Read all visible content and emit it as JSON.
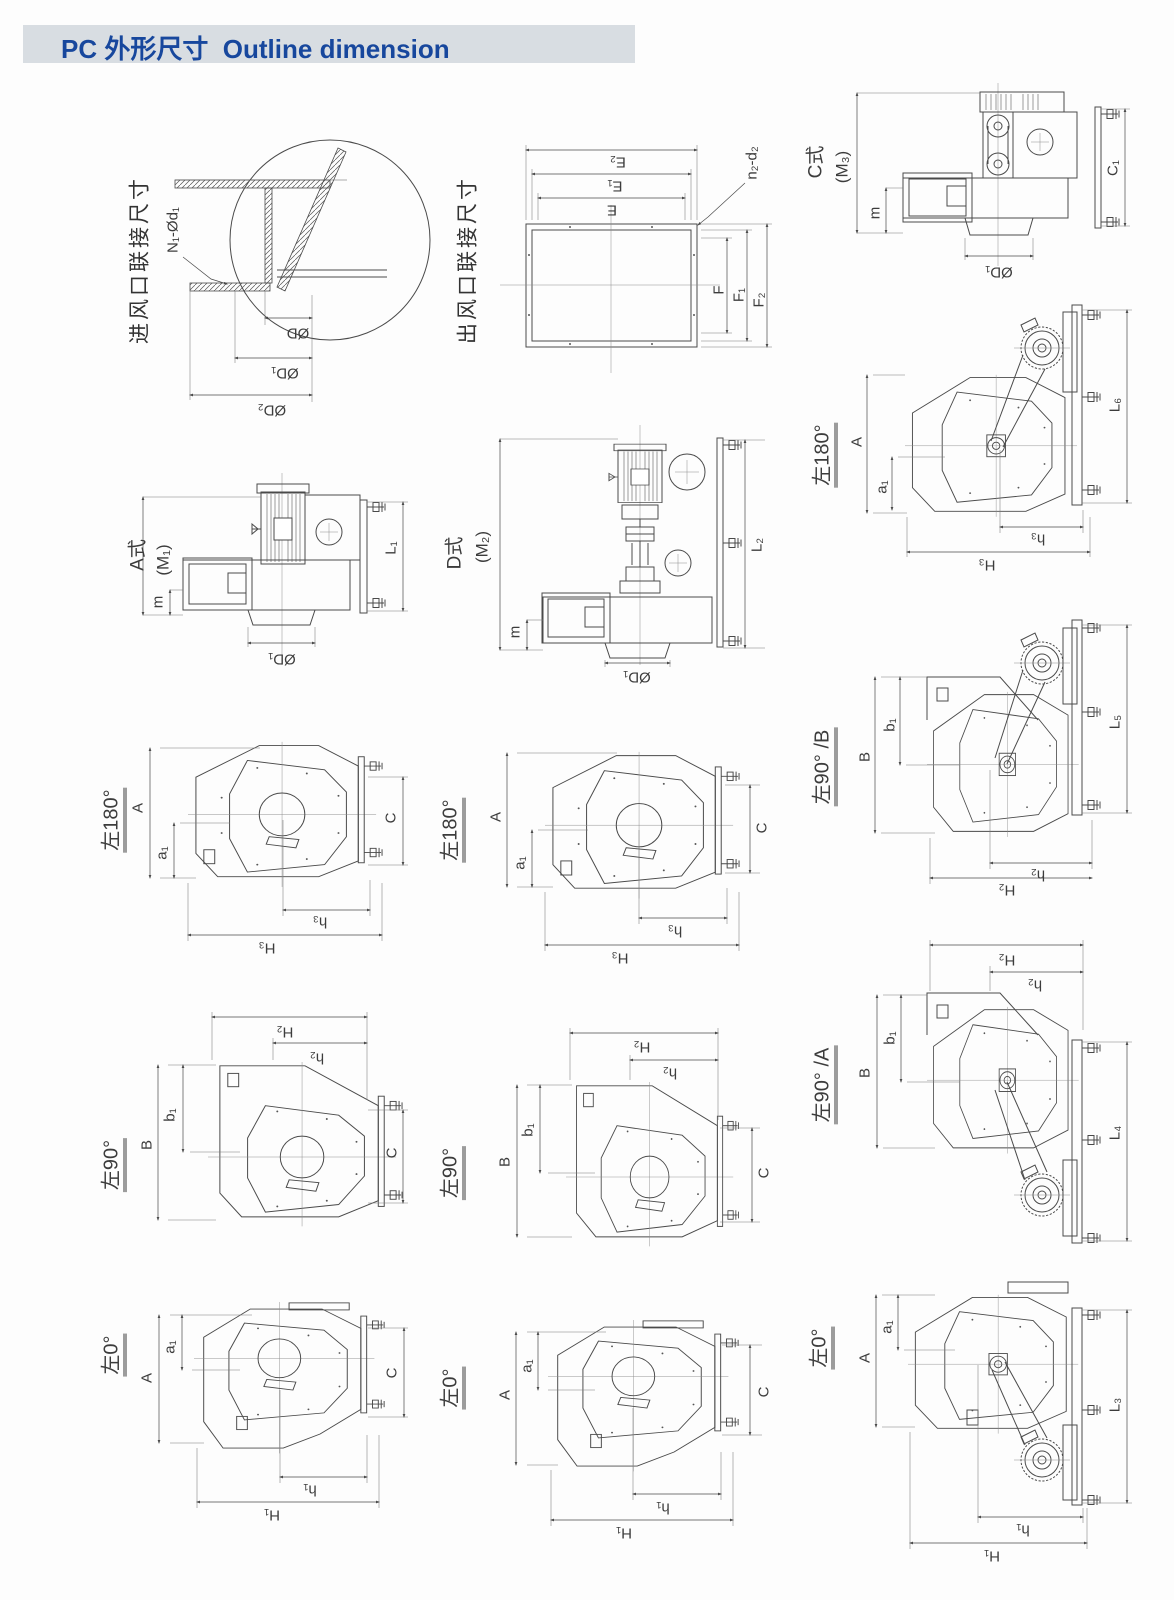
{
  "header": {
    "badge_zh": "PC 外形尺寸",
    "badge_en": "Outline dimension"
  },
  "colors": {
    "accent": "#17479d",
    "band": "#d8dde2",
    "line": "#4a4a4a"
  },
  "cells": {
    "inlet": {
      "title": "进风口联接尺寸",
      "holes": "N₁-Ød₁",
      "d": "ØD",
      "d1": "ØD₁",
      "d2": "ØD₂"
    },
    "outlet": {
      "title": "出风口联接尺寸",
      "e": "E",
      "e1": "E₁",
      "e2": "E₂",
      "f": "F",
      "f1": "F₁",
      "f2": "F₂",
      "holes": "n₂-d₂"
    },
    "type_c": {
      "name": "C式",
      "code": "(M₃)",
      "m": "m",
      "d1": "ØD₁",
      "c1": "C₁"
    },
    "type_a": {
      "name": "A式",
      "code": "(M₁)",
      "m": "m",
      "d1": "ØD₁",
      "l1": "L₁"
    },
    "type_d": {
      "name": "D式",
      "code": "(M₂)",
      "m": "m",
      "d1": "ØD₁",
      "l2": "L₂"
    },
    "side180a": {
      "angle": "左180°",
      "a": "A",
      "a1": "a₁",
      "h3": "h₃",
      "H3": "H₃",
      "l6": "L₆"
    },
    "front180_left": {
      "angle": "左180°",
      "a": "A",
      "a1": "a₁",
      "c": "C",
      "h3": "h₃",
      "H3": "H₃"
    },
    "front180_mid": {
      "angle": "左180°",
      "a": "A",
      "a1": "a₁",
      "c": "C",
      "h3": "h₃",
      "H3": "H₃"
    },
    "side90b": {
      "angle": "左90° /B",
      "b": "B",
      "b1": "b₁",
      "h2": "h₂",
      "H2": "H₂",
      "l5": "L₅"
    },
    "front90_left": {
      "angle": "左90°",
      "b": "B",
      "b1": "b₁",
      "c": "C",
      "h2": "h₂",
      "H2": "H₂"
    },
    "front90_mid": {
      "angle": "左90°",
      "b": "B",
      "b1": "b₁",
      "c": "C",
      "h2": "h₂",
      "H2": "H₂"
    },
    "side90a": {
      "angle": "左90° /A",
      "b": "B",
      "b1": "b₁",
      "h2": "h₂",
      "H2": "H₂",
      "l4": "L₄"
    },
    "front0_left": {
      "angle": "左0°",
      "a": "A",
      "a1": "a₁",
      "c": "C",
      "h1": "h₁",
      "H1": "H₁"
    },
    "front0_mid": {
      "angle": "左0°",
      "a": "A",
      "a1": "a₁",
      "c": "C",
      "h1": "h₁",
      "H1": "H₁"
    },
    "side0": {
      "angle": "左0°",
      "a": "A",
      "a1": "a₁",
      "h1": "h₁",
      "H1": "H₁",
      "l3": "L₃"
    }
  }
}
